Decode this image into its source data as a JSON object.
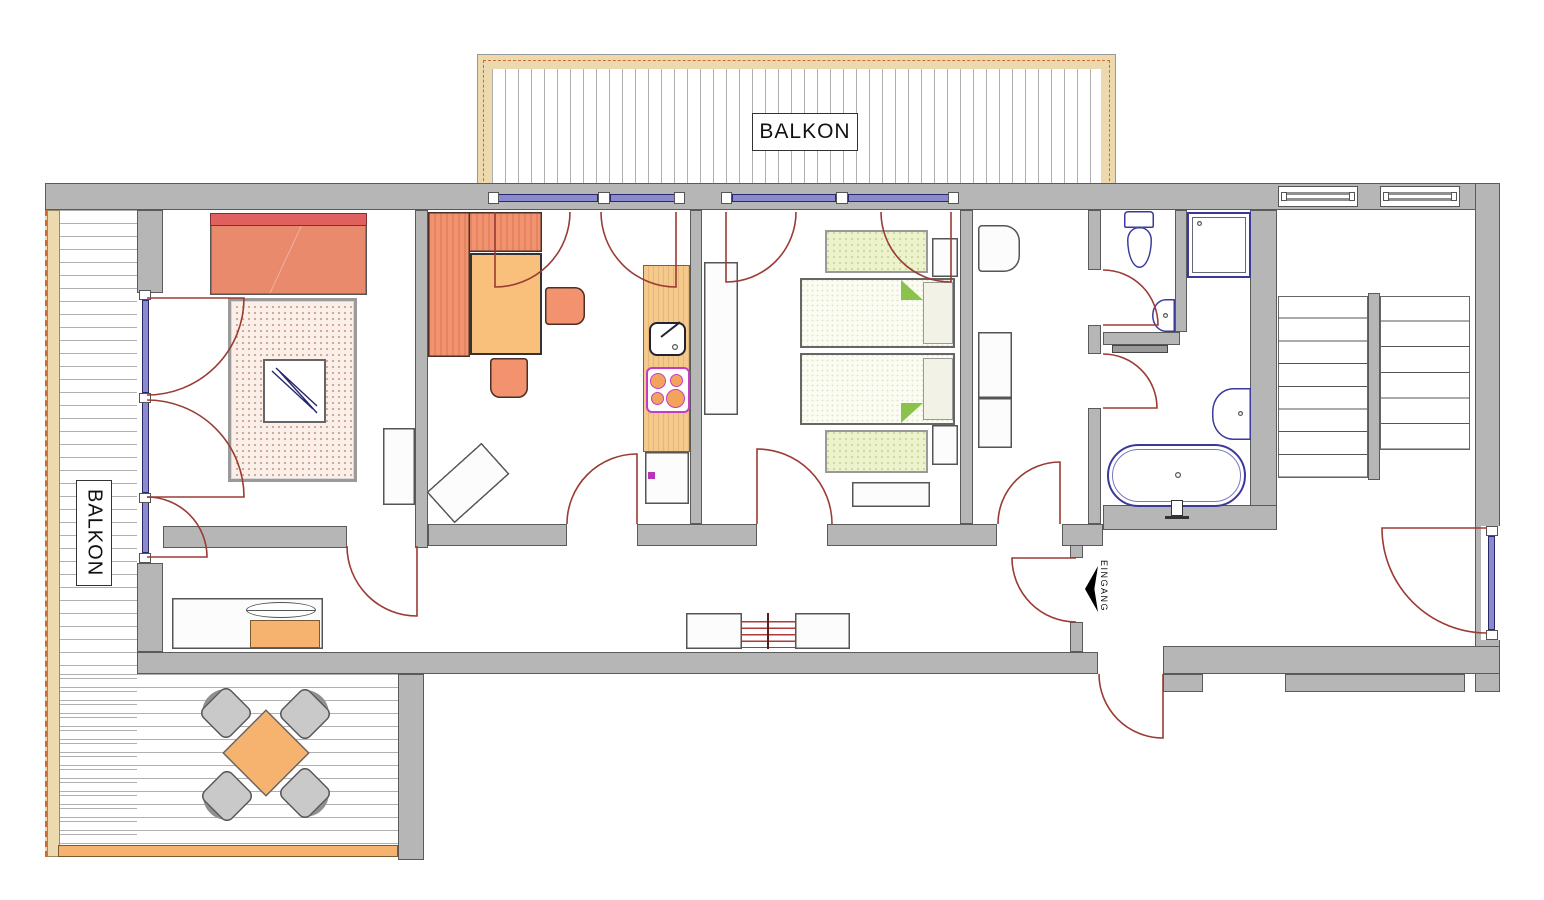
{
  "labels": {
    "balcony_top": "BALKON",
    "balcony_left": "BALKON",
    "entrance": "EINGANG"
  },
  "icons": {
    "entrance_arrow": "left-wedge-arrow",
    "fixture_icons": [
      "double-bed-icon",
      "rug-icon",
      "glass-table-icon",
      "corner-bench-icon",
      "dining-table-icon",
      "chair-icon",
      "kitchen-counter-icon",
      "kitchen-sink-icon",
      "stove-icon",
      "wardrobe-icon",
      "twin-bed-icon",
      "mattress-icon",
      "nightstand-icon",
      "dresser-icon",
      "sideboard-icon",
      "radiator-icon",
      "toilet-icon",
      "washbasin-icon",
      "shower-icon",
      "bathtub-icon",
      "towel-rail-icon",
      "stairs-icon",
      "terrace-table-icon",
      "terrace-chair-icon",
      "door-swing-icon",
      "window-icon"
    ]
  },
  "palette": {
    "wall_fill": "#b6b6b6",
    "wall_edge": "#5a5a5a",
    "door_arc": "#9a3b34",
    "window_blue": "#8a8ace",
    "window_frame": "#2a2a6a",
    "fixture_blue": "#3a3a9d",
    "wood": "#ecdaae",
    "wood_dash": "#cc6a33",
    "bed_salmon": "#e98a6d",
    "pillow_red": "#e05f5f",
    "sofa_salmon": "#f2926e",
    "table_orange": "#f9c07c",
    "counter_wood": "#f4c98b",
    "stove_magenta": "#c43cc4",
    "burner_orange": "#f2a45c",
    "accent_magenta": "#bb33bb",
    "mat_green": "#ecf2cb",
    "fold_green": "#8bc34a",
    "rug_bg": "#faf0e9",
    "rug_dot": "#d2a68f",
    "terrace_orange": "#f6b26f",
    "chair_gray": "#c9c9c9",
    "chair_back": "#8f8f8f",
    "radiator_red": "#b03a3a"
  }
}
